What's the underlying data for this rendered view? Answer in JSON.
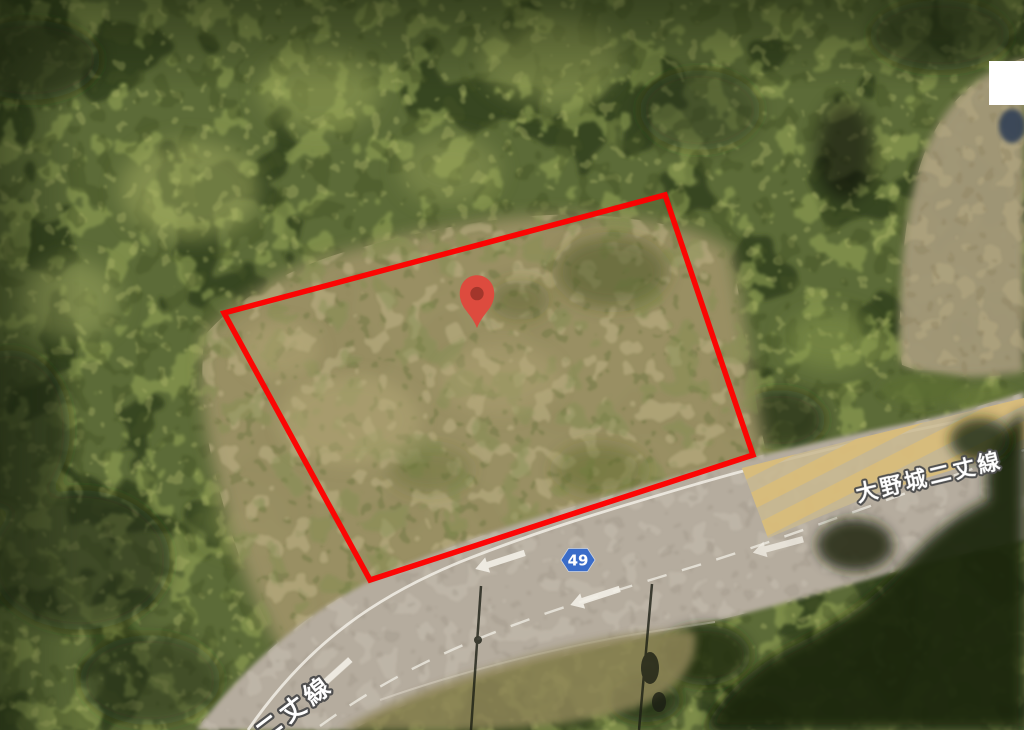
{
  "map": {
    "view_type": "satellite",
    "route_badge": {
      "number": "49",
      "fill": "#3A6CC8",
      "text_color": "#FFFFFF",
      "transform": "translate(578,560)"
    },
    "road_labels": {
      "right": {
        "text": "大野城二丈線",
        "transform": "translate(858,502) rotate(-13.5)"
      },
      "bottom_left": {
        "text": "二丈線",
        "transform": "translate(264,742) rotate(-37)"
      }
    },
    "marker": {
      "type": "location-pin",
      "body_color": "#DD4B3E",
      "dot_color": "#A3362B",
      "transform": "translate(477,312) scale(1.15)"
    },
    "parcel_outline": {
      "color": "#FF0000",
      "stroke_width": 5.5,
      "points_str": "224,313 665,195 753,455 370,580"
    },
    "redaction_box": {
      "x": 989,
      "y": 61,
      "width": 35,
      "height": 44,
      "fill": "#FFFFFF"
    }
  },
  "palette": {
    "forest_base": "#5C6B38",
    "forest_dark": "#2F3D1C",
    "forest_light": "#93A355",
    "scrub": "#9C9266",
    "clearing": "#A39878",
    "road": "#B5AC9E",
    "road_marking": "#F2EFE6",
    "hatch_yellow": "#D9BC79",
    "canopy_shadow": "#1C2610"
  }
}
